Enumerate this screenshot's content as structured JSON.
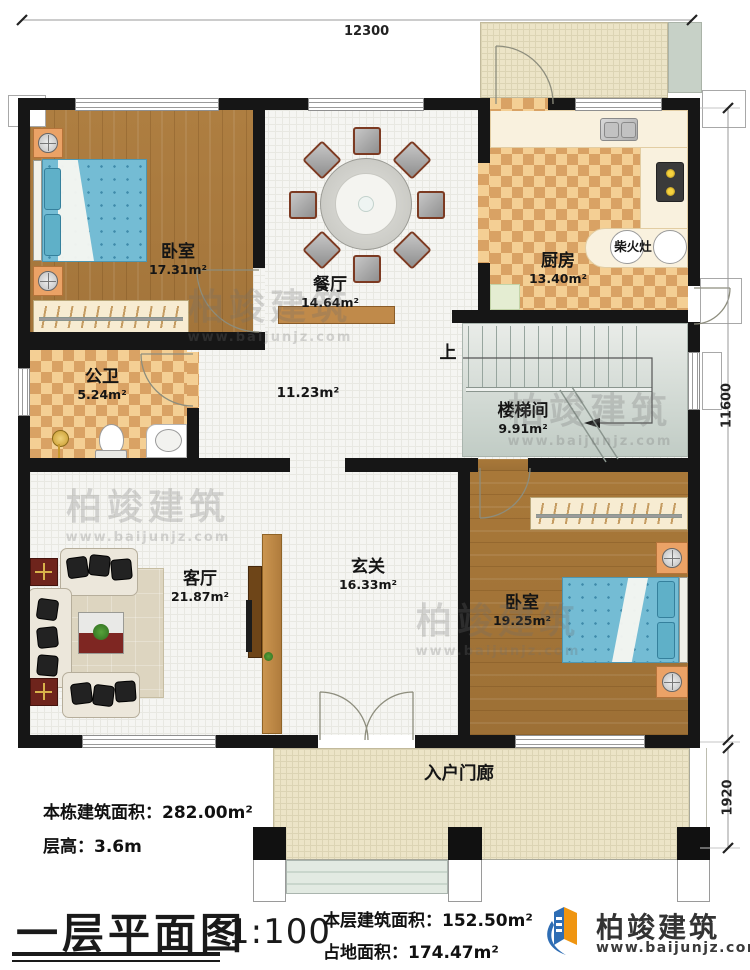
{
  "title": {
    "text": "一层平面图",
    "scale": "1:100"
  },
  "dimensions": {
    "top": "12300",
    "right_upper": "11600",
    "right_lower": "1920"
  },
  "rooms": {
    "bedroom1": {
      "name": "卧室",
      "area": "17.31m²"
    },
    "dining": {
      "name": "餐厅",
      "area": "14.64m²"
    },
    "kitchen": {
      "name": "厨房",
      "area": "13.40m²"
    },
    "stove": {
      "label": "柴火灶"
    },
    "bathroom": {
      "name": "公卫",
      "area": "5.24m²"
    },
    "hallway": {
      "area": "11.23m²"
    },
    "stairwell": {
      "name": "楼梯间",
      "area": "9.91m²",
      "up_label": "上"
    },
    "living": {
      "name": "客厅",
      "area": "21.87m²"
    },
    "foyer": {
      "name": "玄关",
      "area": "16.33m²"
    },
    "bedroom2": {
      "name": "卧室",
      "area": "19.25m²"
    },
    "porch": {
      "name": "入户门廊"
    }
  },
  "info": {
    "building_total": "本栋建筑面积：282.00m²",
    "floor_height": "层高：3.6m",
    "floor_area": "本层建筑面积：152.50m²",
    "footprint": "占地面积：174.47m²"
  },
  "brand": {
    "name": "柏竣建筑",
    "url": "www.baijunjz.com"
  },
  "watermark": {
    "name": "柏竣建筑",
    "url": "www.baijunjz.com"
  },
  "colors": {
    "wall": "#161616",
    "wood": "#a87839",
    "checker_dark": "#d9a264",
    "checker_light": "#f4cf94",
    "brand_blue": "#2e6db4",
    "brand_orange": "#ef9511"
  }
}
